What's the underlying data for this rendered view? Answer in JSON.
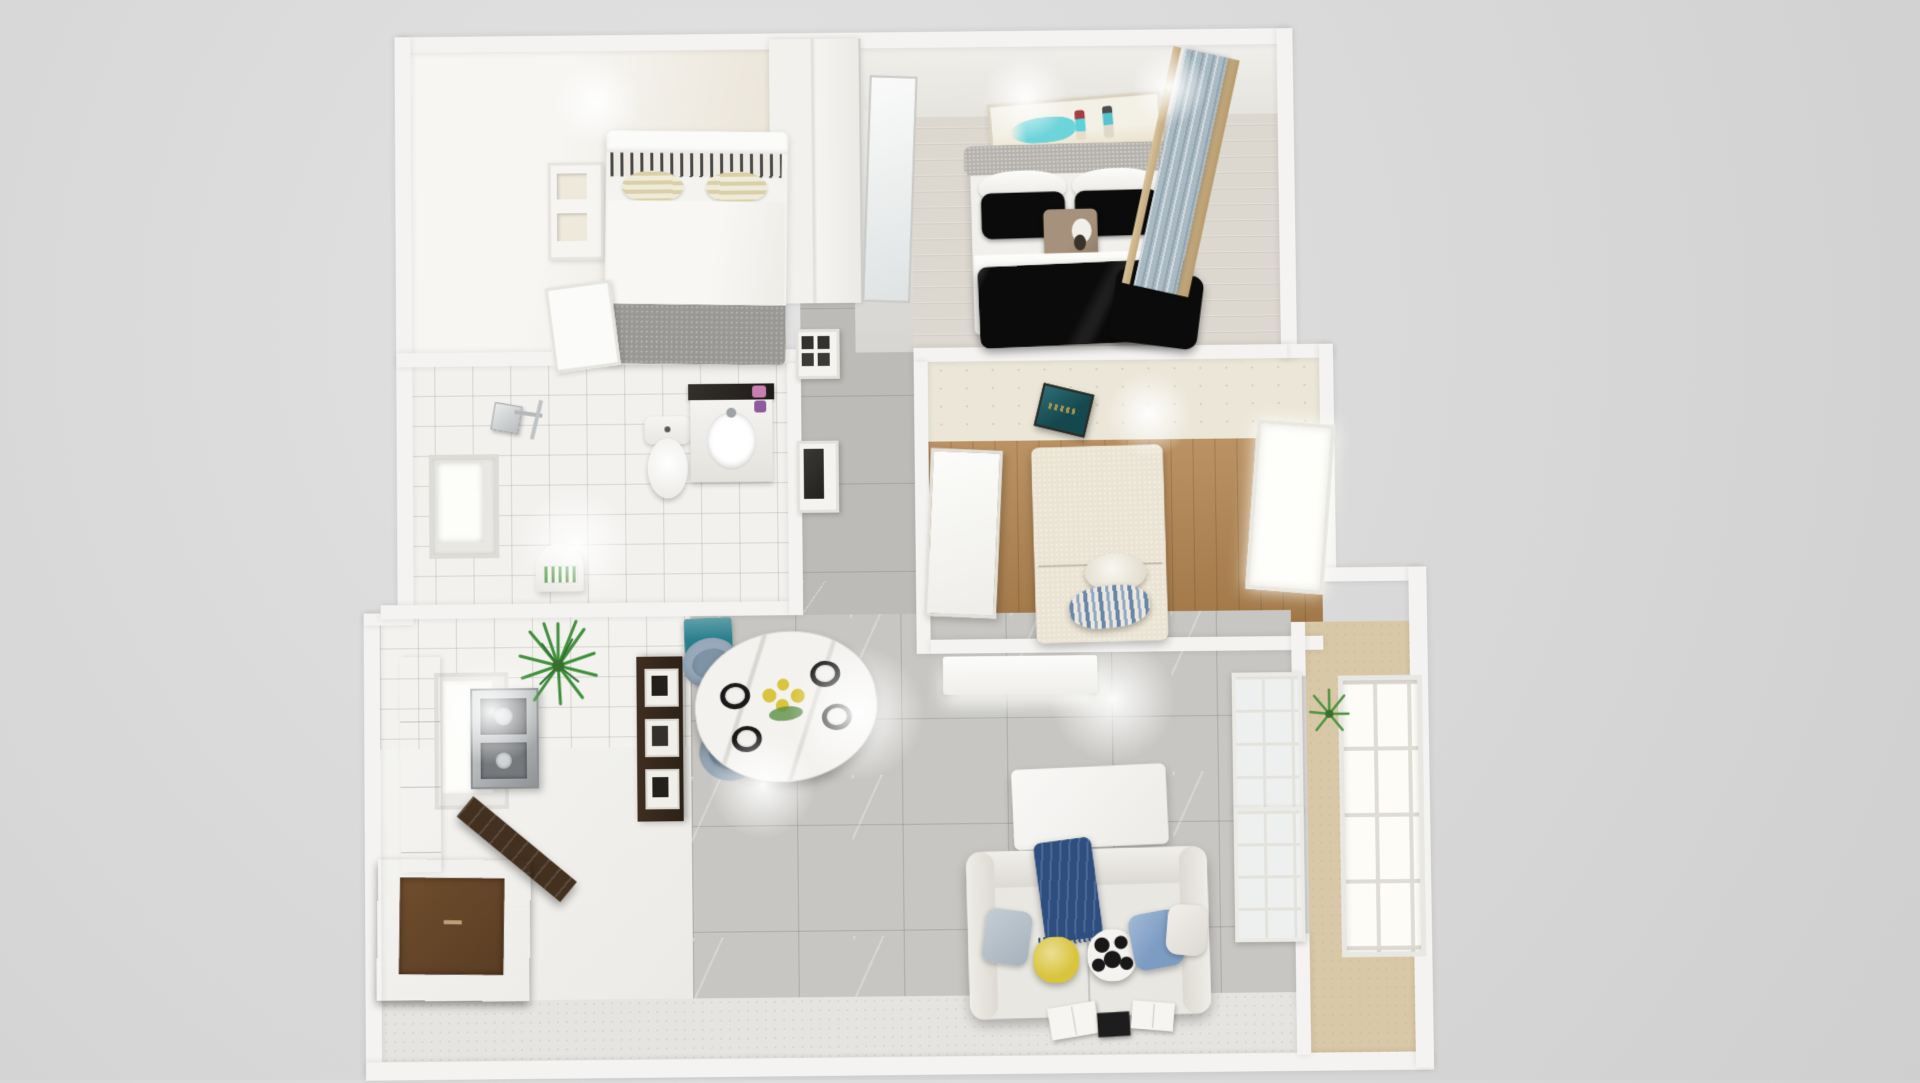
{
  "scene": {
    "title": "Apartment 3D floor plan render",
    "view": "top-down dollhouse perspective",
    "background_color": "#d8d8d8",
    "wall_color": "#f4f3f1"
  },
  "palette": {
    "living_tile": "#c7c6c2",
    "hall_marble": "#bcbbb7",
    "wood_floor": "#b1834e",
    "whitewash_floor": "#dcd7cf",
    "bath_tile": "#f2f1ee",
    "wallpaper": "#ebe6d8",
    "balcony_floor": "#d9c8a7",
    "teal_accent": "#2a7f8d",
    "plaque_teal": "#15484e",
    "navy_throw": "#2e4e80",
    "duvet_black": "#0b0b0b",
    "sofa_fabric": "#e9e7e2",
    "chair_blue_gray": "#97a9ba",
    "pillow_yellow": "#d9c43d",
    "pillow_blue": "#7d9cc4",
    "plant_green": "#3f8f3b",
    "counter_walnut": "#43301f",
    "steel": "#a9adb0",
    "curtain_blue": "#a9bac4",
    "art_teal": "#5ed2da"
  },
  "rooms": {
    "bedroom_left": {
      "name": "Bedroom (white bed)",
      "furniture": [
        "white double bed with gray foot throw",
        "patterned pillows",
        "wall shelf",
        "white door",
        "sliding wardrobe divider"
      ]
    },
    "bedroom_master": {
      "name": "Master bedroom",
      "furniture": [
        "double bed with black duvet",
        "gray upholstered headboard",
        "beach couple artwork",
        "blue curtain window",
        "leaning floor mirror"
      ]
    },
    "hallway": {
      "name": "Hallway",
      "furniture": [
        "gray marble floor",
        "built-in appliance column"
      ]
    },
    "bathroom": {
      "name": "Bathroom",
      "furniture": [
        "rain shower",
        "frosted window",
        "toilet",
        "vanity with sink"
      ]
    },
    "bedroom_study": {
      "name": "Bedroom / study",
      "furniture": [
        "patterned wallpaper band",
        "teal wall plaque",
        "walnut plank floor",
        "white door",
        "daybed with round and striped pillows",
        "bright window"
      ]
    },
    "kitchen": {
      "name": "Kitchen",
      "furniture": [
        "white gloss cabinets",
        "stainless cooktop module",
        "window",
        "potted spiky plant",
        "walnut bar counter",
        "display shelf with frames",
        "arched decor piece"
      ]
    },
    "dining": {
      "name": "Dining area",
      "furniture": [
        "oval marble table",
        "yellow flower centerpiece",
        "four place settings",
        "four blue-gray tub chairs",
        "teal sideboard"
      ]
    },
    "living": {
      "name": "Living room",
      "furniture": [
        "white media console",
        "white coffee table",
        "fabric sofa",
        "navy throw",
        "yellow pillow",
        "soccer-ball pillow",
        "blue pillows",
        "open magazines on floor"
      ]
    },
    "balcony": {
      "name": "Balcony",
      "furniture": [
        "tan stone floor",
        "white french doors",
        "gridded window wall",
        "potted plant"
      ]
    }
  }
}
